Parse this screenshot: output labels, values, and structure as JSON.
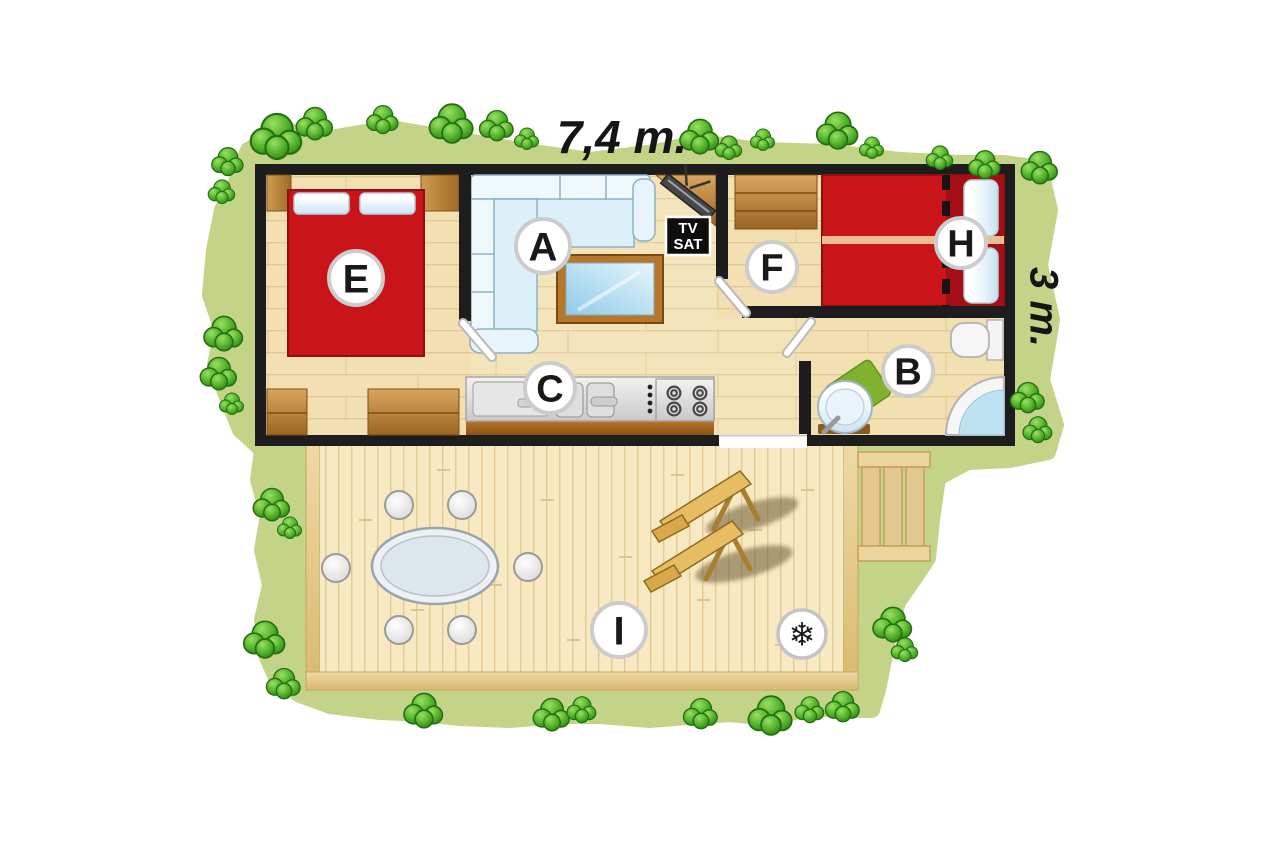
{
  "plan": {
    "width_label": "7,4 m.",
    "height_label": "3 m."
  },
  "rooms": [
    {
      "label": "E"
    },
    {
      "label": "A"
    },
    {
      "label": "C"
    },
    {
      "label": "F"
    },
    {
      "label": "H"
    },
    {
      "label": "B"
    },
    {
      "label": "I"
    }
  ],
  "tv_sat": {
    "line1": "TV",
    "line2": "SAT"
  },
  "icons": {
    "air_conditioning": "❄"
  },
  "colors": {
    "grass": "#c3d488",
    "bush_stroke": "#256f10",
    "wall": "#1d1d1d",
    "floor_base": "#f2e0b2",
    "deck_base": "#f7e9c2",
    "bed_red": "#c9141a",
    "bed_red_dark": "#a30f14",
    "mat_green": "#7fb22e"
  }
}
